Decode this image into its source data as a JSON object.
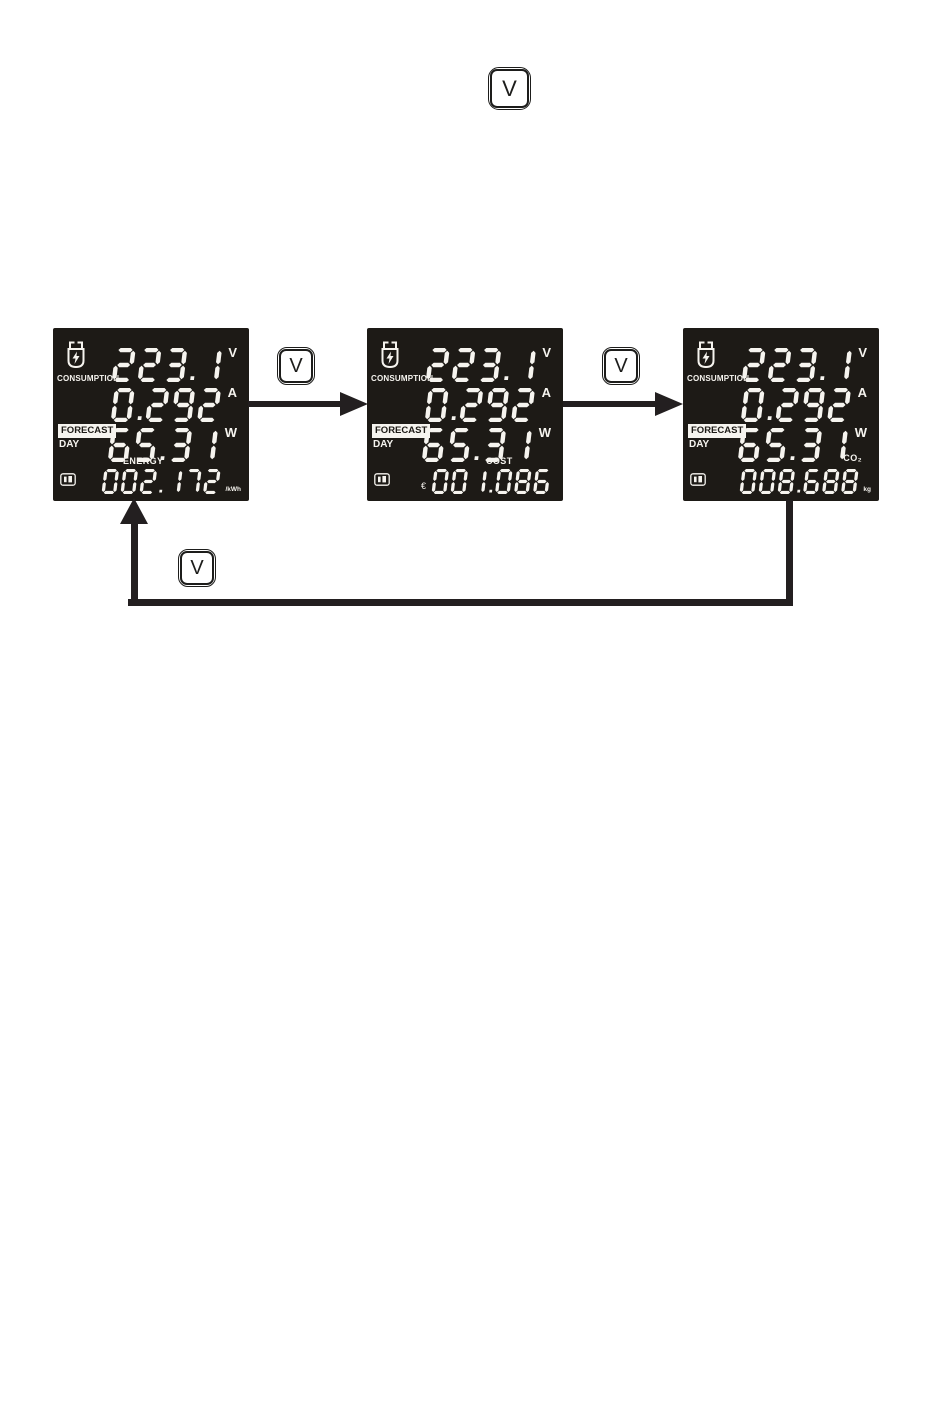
{
  "colors": {
    "page_bg": "#ffffff",
    "panel_bg": "#1d1a16",
    "digit": "#f6f4ef",
    "line": "#231f20"
  },
  "key_buttons": {
    "top_label": "V",
    "between_first_second_label": "V",
    "between_second_third_label": "V",
    "return_label": "V"
  },
  "icons": {
    "plug": "power-plug-icon",
    "memory": "memory-card-icon"
  },
  "panels": [
    {
      "consumption_label": "CONSUMPTION",
      "forecast_label": "FORECAST",
      "day_label": "DAY",
      "rows": [
        {
          "value": "223.1",
          "unit": "V"
        },
        {
          "value": "0.292",
          "unit": "A"
        },
        {
          "value": "65.31",
          "unit": "W"
        }
      ],
      "bottom": {
        "label": "ENERGY",
        "prefix": "",
        "value": "002.172",
        "unit": "/kWh"
      }
    },
    {
      "consumption_label": "CONSUMPTION",
      "forecast_label": "FORECAST",
      "day_label": "DAY",
      "rows": [
        {
          "value": "223.1",
          "unit": "V"
        },
        {
          "value": "0.292",
          "unit": "A"
        },
        {
          "value": "65.31",
          "unit": "W"
        }
      ],
      "bottom": {
        "label": "COST",
        "prefix": "€",
        "value": "001.086",
        "unit": ""
      }
    },
    {
      "consumption_label": "CONSUMPTION",
      "forecast_label": "FORECAST",
      "day_label": "DAY",
      "rows": [
        {
          "value": "223.1",
          "unit": "V"
        },
        {
          "value": "0.292",
          "unit": "A"
        },
        {
          "value": "65.31",
          "unit": "W"
        }
      ],
      "bottom": {
        "label": "CO₂",
        "prefix": "",
        "value": "008.688",
        "unit": "kg"
      }
    }
  ]
}
